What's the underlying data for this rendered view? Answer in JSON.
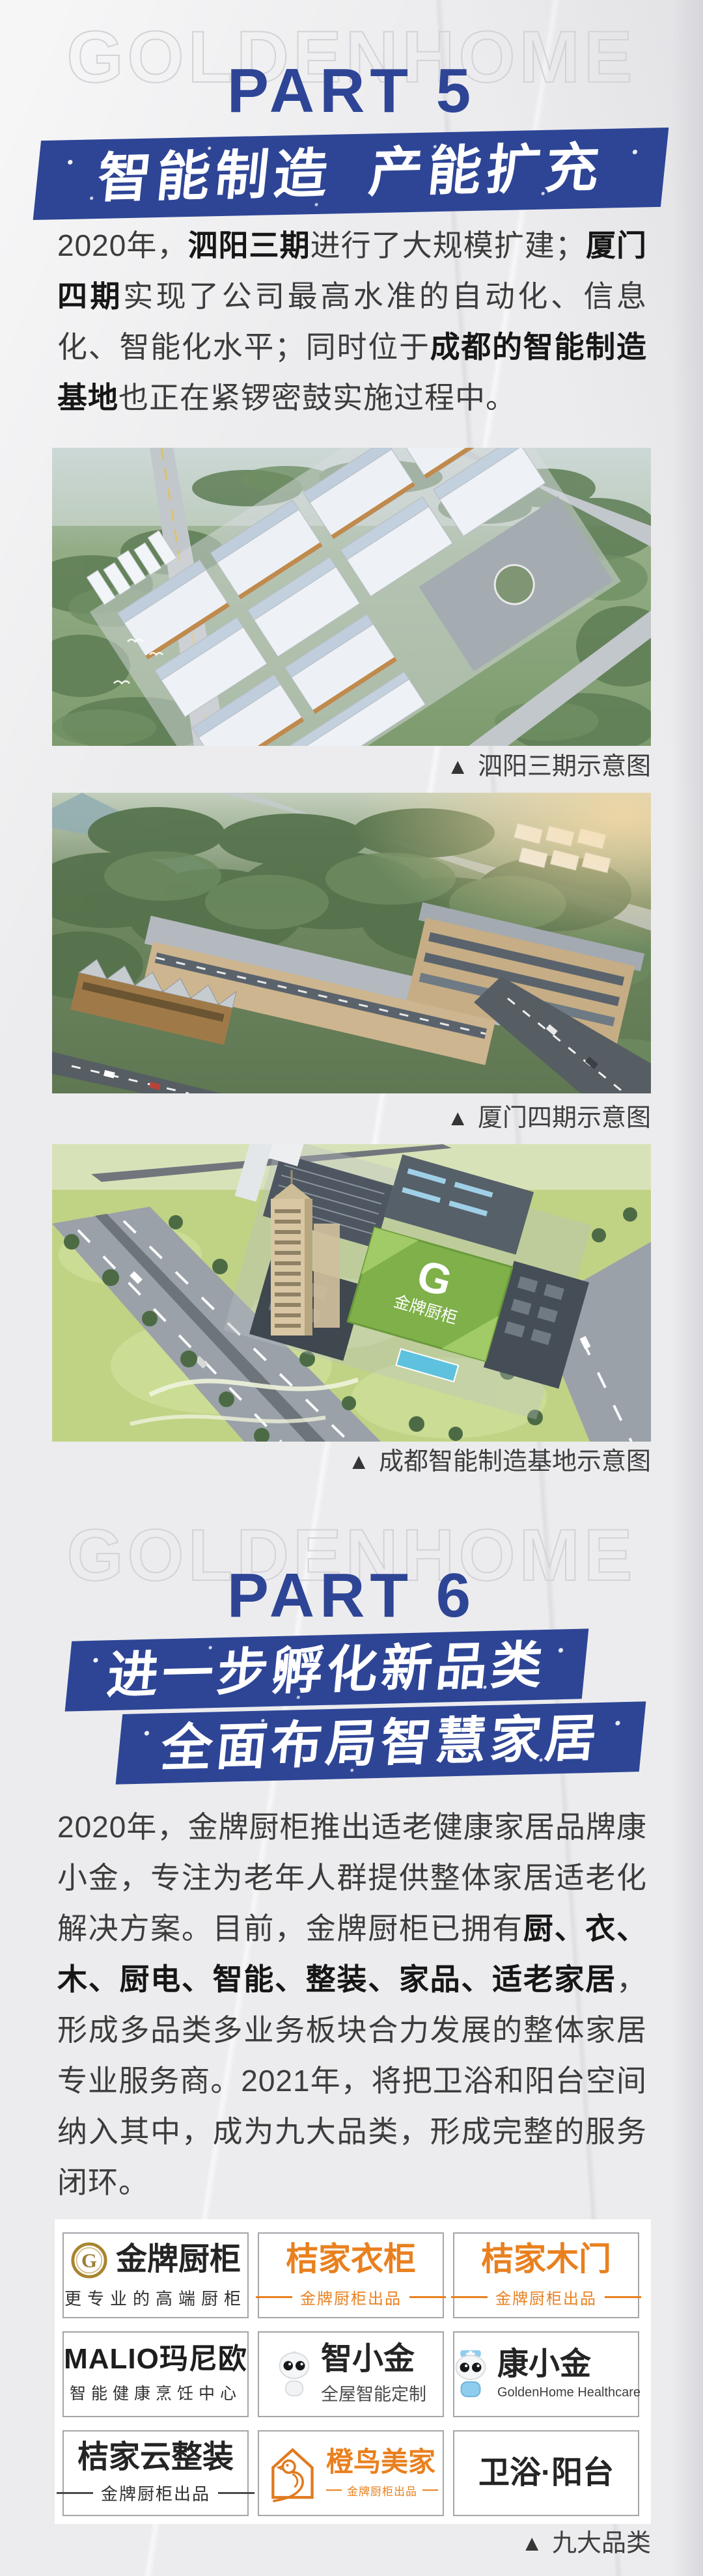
{
  "ui": {
    "marker": "▲"
  },
  "colors": {
    "accent_blue": "#2e4596",
    "brand_orange": "#e9801f"
  },
  "part5": {
    "watermark": "GOLDENHOME",
    "label": "PART 5",
    "banner": {
      "left": "智能制造",
      "right": "产能扩充"
    },
    "paragraph": [
      {
        "text": "2020年，",
        "bold": false
      },
      {
        "text": "泗阳三期",
        "bold": true
      },
      {
        "text": "进行了大规模扩建；",
        "bold": false
      },
      {
        "text": "厦门四期",
        "bold": true
      },
      {
        "text": "实现了公司最高水准的自动化、信息化、智能化水平；同时位于",
        "bold": false
      },
      {
        "text": "成都的智能制造基地",
        "bold": true
      },
      {
        "text": "也正在紧锣密鼓实施过程中。",
        "bold": false
      }
    ],
    "figures": [
      {
        "caption": "泗阳三期示意图"
      },
      {
        "caption": "厦门四期示意图"
      },
      {
        "caption": "成都智能制造基地示意图",
        "roof_logo": "G",
        "roof_text": "金牌厨柜"
      }
    ]
  },
  "part6": {
    "watermark": "GOLDENHOME",
    "label": "PART 6",
    "banners": [
      "进一步孵化新品类",
      "全面布局智慧家居"
    ],
    "paragraph": [
      {
        "text": "2020年，金牌厨柜推出适老健康家居品牌康小金，专注为老年人群提供整体家居适老化解决方案。目前，金牌厨柜已拥有",
        "bold": false
      },
      {
        "text": "厨、衣、木、厨电、智能、整装、家品、适老家居",
        "bold": true
      },
      {
        "text": "，形成多品类多业务板块合力发展的整体家居专业服务商。2021年，将把卫浴和阳台空间纳入其中，成为九大品类，形成完整的服务闭环。",
        "bold": false
      }
    ],
    "brands": [
      {
        "logo": "G",
        "name": "金牌厨柜",
        "tagline": "更专业的高端厨柜"
      },
      {
        "name": "桔家衣柜",
        "tagline": "金牌厨柜出品"
      },
      {
        "name": "桔家木门",
        "tagline": "金牌厨柜出品"
      },
      {
        "name": "MALIO玛尼欧",
        "tagline": "智能健康烹饪中心"
      },
      {
        "name": "智小金",
        "tagline": "全屋智能定制"
      },
      {
        "name": "康小金",
        "tagline": "GoldenHome Healthcare"
      },
      {
        "name": "桔家云整装",
        "tagline": "金牌厨柜出品"
      },
      {
        "name": "橙鸟美家",
        "tagline": "金牌厨柜出品"
      },
      {
        "name": "卫浴·阳台",
        "tagline": ""
      }
    ],
    "grid_caption": "九大品类"
  }
}
